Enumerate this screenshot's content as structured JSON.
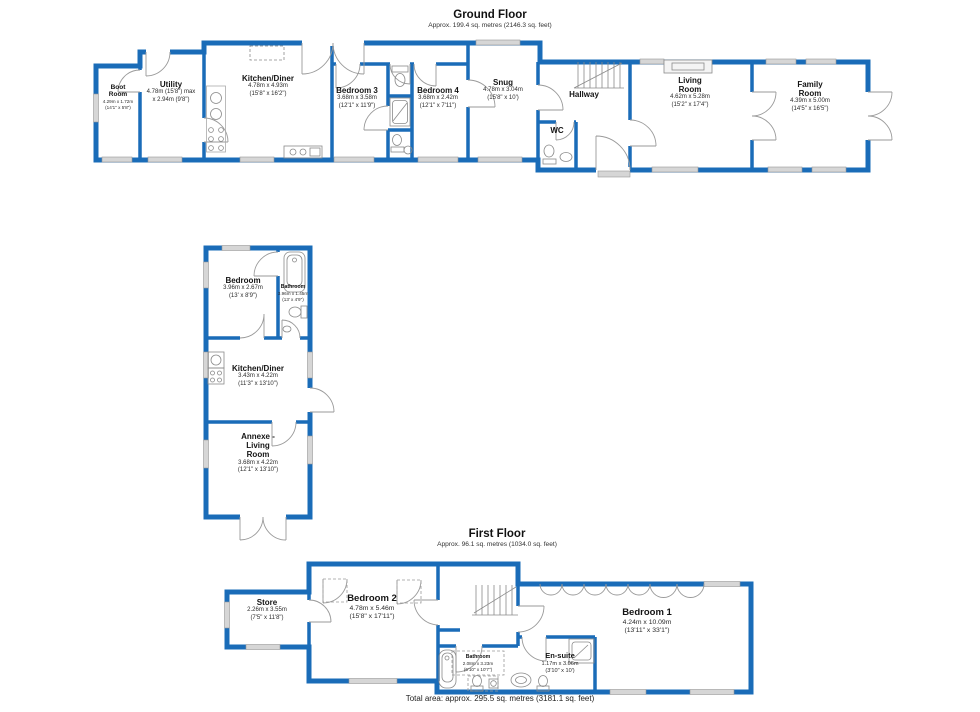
{
  "colors": {
    "wall_blue": "#1a6cb8",
    "window_gray": "#d6d6d6",
    "fixture_gray": "#8a8a8a",
    "text": "#141414"
  },
  "ground_floor": {
    "title": "Ground Floor",
    "subtitle": "Approx. 199.4 sq. metres (2146.3 sq. feet)",
    "rooms": {
      "boot": {
        "name": "Boot\nRoom",
        "m": "4.29m x 1.72m",
        "ft": "(14'1\" x 5'8\")"
      },
      "utility": {
        "name": "Utility",
        "m": "4.78m (15'8\") max",
        "ft": "x 2.94m (9'8\")"
      },
      "kitchen": {
        "name": "Kitchen/Diner",
        "m": "4.78m x 4.93m",
        "ft": "(15'8\" x 16'2\")"
      },
      "bed3": {
        "name": "Bedroom 3",
        "m": "3.68m x 3.58m",
        "ft": "(12'1\" x 11'9\")"
      },
      "bed4": {
        "name": "Bedroom 4",
        "m": "3.68m x 2.42m",
        "ft": "(12'1\" x 7'11\")"
      },
      "snug": {
        "name": "Snug",
        "m": "4.78m x 3.04m",
        "ft": "(15'8\" x 10')"
      },
      "hallway": {
        "name": "Hallway"
      },
      "wc": {
        "name": "WC"
      },
      "living": {
        "name": "Living\nRoom",
        "m": "4.62m x 5.28m",
        "ft": "(15'2\" x 17'4\")"
      },
      "family": {
        "name": "Family\nRoom",
        "m": "4.39m x 5.00m",
        "ft": "(14'5\" x 16'5\")"
      }
    }
  },
  "annexe": {
    "rooms": {
      "bedroom": {
        "name": "Bedroom",
        "m": "3.96m x 2.67m",
        "ft": "(13' x 8'9\")"
      },
      "bathroom": {
        "name": "Bathroom",
        "m": "3.96m x 1.45m",
        "ft": "(13' x 4'9\")"
      },
      "kitchen": {
        "name": "Kitchen/Diner",
        "m": "3.43m x 4.22m",
        "ft": "(11'3\" x 13'10\")"
      },
      "living": {
        "name": "Annexe -\nLiving\nRoom",
        "m": "3.68m x 4.22m",
        "ft": "(12'1\" x 13'10\")"
      }
    }
  },
  "first_floor": {
    "title": "First Floor",
    "subtitle": "Approx. 96.1 sq. metres (1034.0 sq. feet)",
    "rooms": {
      "store": {
        "name": "Store",
        "m": "2.26m x 3.55m",
        "ft": "(7'5\" x 11'8\")"
      },
      "bed2": {
        "name": "Bedroom 2",
        "m": "4.78m x 5.46m",
        "ft": "(15'8\" x 17'11\")"
      },
      "bath": {
        "name": "Bathroom",
        "m": "2.08m x 3.23m",
        "ft": "(6'10\" x 10'7\")"
      },
      "ensuite": {
        "name": "En-suite",
        "m": "1.17m x 3.06m",
        "ft": "(3'10\" x 10')"
      },
      "bed1": {
        "name": "Bedroom 1",
        "m": "4.24m x 10.09m",
        "ft": "(13'11\" x 33'1\")"
      }
    }
  },
  "footer": {
    "total": "Total area: approx. 295.5 sq. metres (3181.1 sq. feet)"
  }
}
